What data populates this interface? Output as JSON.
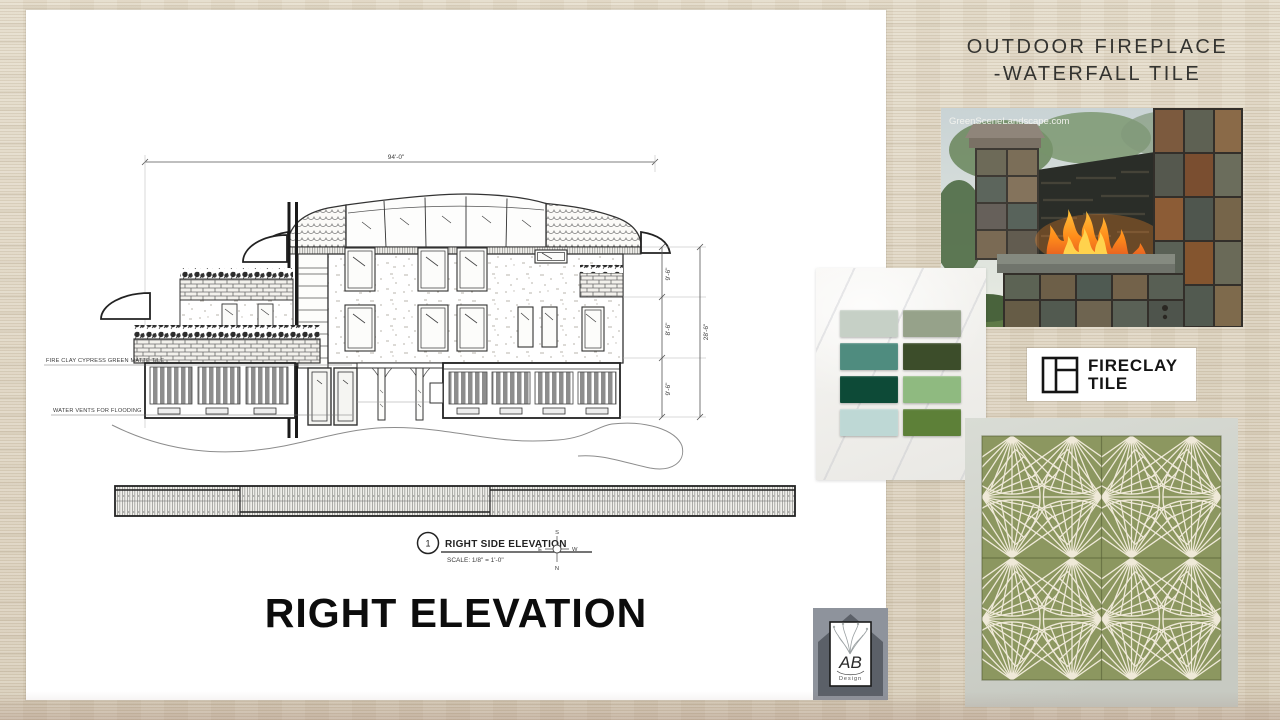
{
  "board_title": {
    "line1": "OUTDOOR FIREPLACE",
    "line2": "-WATERFALL TILE"
  },
  "elevation_panel": {
    "caption": "RIGHT ELEVATION",
    "drawing": {
      "detail_number": "1",
      "title": "RIGHT SIDE ELEVATION",
      "scale": "SCALE: 1/8\" = 1'-0\"",
      "compass": {
        "top": "S",
        "left": "E",
        "right": "W",
        "bottom": "N"
      },
      "annotations": [
        "FIRE CLAY CYPRESS GREEN MATTE TILE",
        "WATER VENTS FOR FLOODING"
      ],
      "dimensions": {
        "top": "94'-0\"",
        "right_segments": [
          "9'-6\"",
          "8'-6\"",
          "9'-6\""
        ],
        "right_overall": "28'-6\""
      }
    }
  },
  "fireplace_photo": {
    "watermark": "GreenSceneLandscape.com"
  },
  "tile_samples": {
    "swatches": [
      {
        "name": "light-sage",
        "color": "#c6d0c6"
      },
      {
        "name": "gray-green",
        "color": "#96a28a"
      },
      {
        "name": "teal-green",
        "color": "#4f8c7f"
      },
      {
        "name": "dark-forest",
        "color": "#3c4d2a"
      },
      {
        "name": "emerald-green",
        "color": "#0d4a37"
      },
      {
        "name": "medium-green",
        "color": "#8fba80"
      },
      {
        "name": "pale-aqua",
        "color": "#bed8d5"
      },
      {
        "name": "moss-green",
        "color": "#5d8038"
      }
    ]
  },
  "fireclay_logo": {
    "line1": "FIRECLAY",
    "line2": "TILE"
  },
  "pattern_tile": {
    "tile_color": "#8c9760",
    "line_color": "#efe9d8"
  },
  "ab_logo": {
    "monogram": "AB",
    "subtext": "Design"
  }
}
